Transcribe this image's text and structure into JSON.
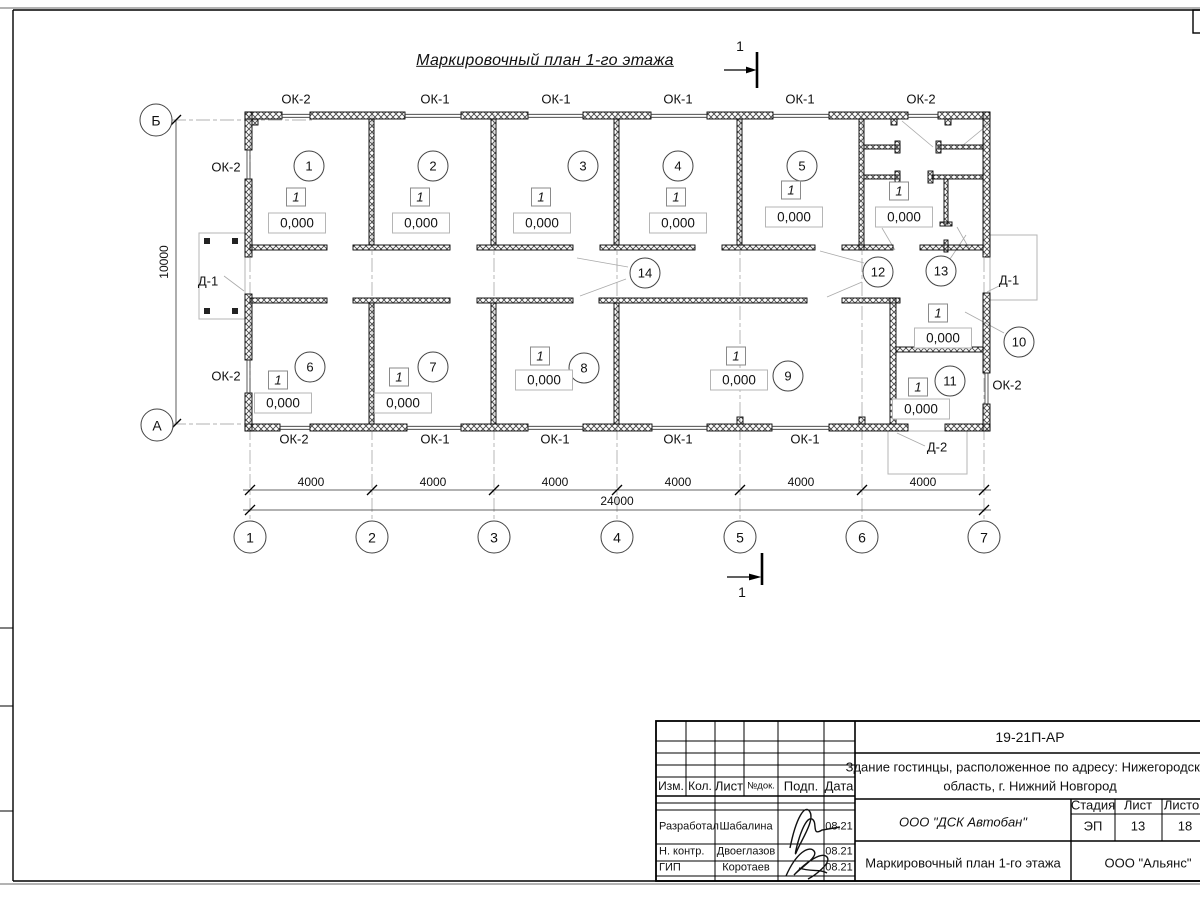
{
  "sheet": {
    "title": "Маркировочный план 1-го этажа",
    "section_label": "1"
  },
  "plan": {
    "room_numbers": [
      "1",
      "2",
      "3",
      "4",
      "5",
      "6",
      "7",
      "8",
      "9",
      "10",
      "11",
      "12",
      "13",
      "14"
    ],
    "unit_marker": "1",
    "elevation": "0,000",
    "window_labels": {
      "top": [
        "ОК-2",
        "ОК-1",
        "ОК-1",
        "ОК-1",
        "ОК-1",
        "ОК-2"
      ],
      "bottom": [
        "ОК-2",
        "ОК-1",
        "ОК-1",
        "ОК-1",
        "ОК-1"
      ],
      "left": [
        "ОК-2",
        "ОК-2"
      ],
      "right": [
        "ОК-2"
      ]
    },
    "door_labels": [
      "Д-1",
      "Д-1",
      "Д-2"
    ],
    "axes": {
      "horizontal": [
        "1",
        "2",
        "3",
        "4",
        "5",
        "6",
        "7"
      ],
      "vertical": [
        "А",
        "Б"
      ]
    },
    "dimensions": {
      "spans": [
        "4000",
        "4000",
        "4000",
        "4000",
        "4000",
        "4000"
      ],
      "total": "24000",
      "height": "10000"
    }
  },
  "titleblock": {
    "doc_number": "19-21П-АР",
    "project_line1": "Здание гостинцы, расположенное по адресу: Нижегородская",
    "project_line2": "область, г. Нижний Новгород",
    "columns": [
      "Изм.",
      "Кол.",
      "Лист",
      "№док.",
      "Подп.",
      "Дата"
    ],
    "stage_header": "Стадия",
    "sheet_header": "Лист",
    "sheets_header": "Листов",
    "stage": "ЭП",
    "sheet": "13",
    "sheets": "18",
    "contractor": "ООО \"ДСК Автобан\"",
    "drawing_name": "Маркировочный план 1-го этажа",
    "company": "ООО \"Альянс\"",
    "staff": [
      {
        "role": "Разработал",
        "name": "Шабалина",
        "date": "08.21"
      },
      {
        "role": "Н. контр.",
        "name": "Двоеглазов",
        "date": "08.21"
      },
      {
        "role": "ГИП",
        "name": "Коротаев",
        "date": "08.21"
      }
    ]
  }
}
